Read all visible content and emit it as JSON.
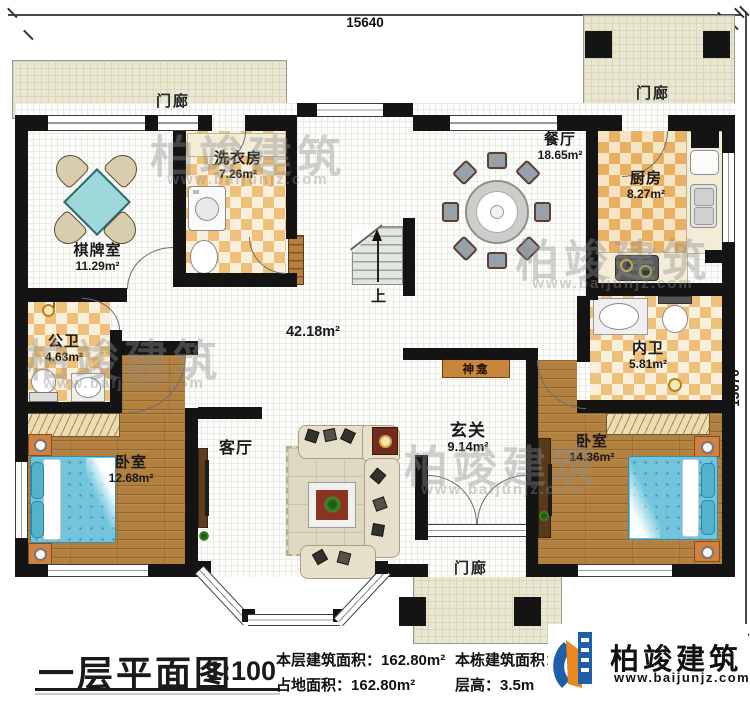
{
  "dims": {
    "top": "15640",
    "right": "13670"
  },
  "rooms": {
    "chess": {
      "name": "棋牌室",
      "area": "11.29m²"
    },
    "laundry": {
      "name": "洗衣房",
      "area": "7.26m²"
    },
    "dining": {
      "name": "餐厅",
      "area": "18.65m²"
    },
    "kitchen": {
      "name": "厨房",
      "area": "8.27m²"
    },
    "pub_bath": {
      "name": "公卫",
      "area": "4.63m²"
    },
    "in_bath": {
      "name": "内卫",
      "area": "5.81m²"
    },
    "bedroom_left": {
      "name": "卧室",
      "area": "12.68m²"
    },
    "bedroom_right": {
      "name": "卧室",
      "area": "14.36m²"
    },
    "foyer": {
      "name": "玄关",
      "area": "9.14m²"
    },
    "living": {
      "name": "客厅"
    },
    "hall": {
      "area": "42.18m²"
    }
  },
  "porch": {
    "name": "门廊"
  },
  "shrine": {
    "name": "神龛"
  },
  "stairs": {
    "up_label": "上"
  },
  "title_block": {
    "title": "一层平面图",
    "scale": "1:100",
    "floor_area_label": "本层建筑面积：",
    "floor_area_value": "162.80m²",
    "land_area_label": "占地面积：",
    "land_area_value": "162.80m²",
    "total_area_label": "本栋建筑面积：",
    "total_area_visible": "9",
    "height_label": "层高：",
    "height_value": "3.5m"
  },
  "logo": {
    "name": "柏竣建筑",
    "url": "www.baijunjz.com"
  },
  "watermark": {
    "text": "柏竣建筑",
    "url": "www.baijunjz.com"
  },
  "colors": {
    "wall": "#141414",
    "checker_warm": "#eec07a",
    "checker_light": "#f8efdc",
    "kitchen_checker": "#e9af62",
    "wood": "#b2803f",
    "porch": "#e9e7d1",
    "bed_blue": "#72c5dd",
    "nightstand_orange": "#d08040",
    "shrine_orange": "#c8863c",
    "logo_blue": "#1d5fa8",
    "logo_orange": "#e8881f",
    "watermark_gray": "#8f8f8f"
  }
}
